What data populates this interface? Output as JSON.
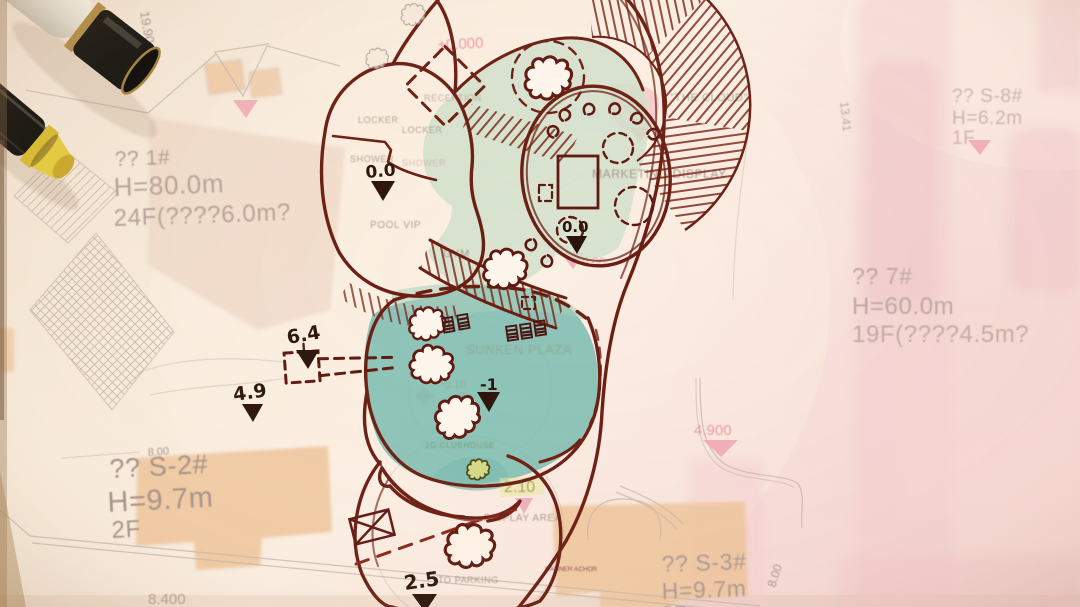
{
  "plan": {
    "b1": {
      "l1": "?? 1#",
      "l2": "H=80.0m",
      "l3": "24F(????6.0m?"
    },
    "s8": {
      "l1": "?? S-8#",
      "l2": "H=6.2m",
      "l3": "1F"
    },
    "b7": {
      "l1": "?? 7#",
      "l2": "H=60.0m",
      "l3": "19F(????4.5m?"
    },
    "s2": {
      "l1": "?? S-2#",
      "l2": "H=9.7m",
      "l3": "2F"
    },
    "s3": {
      "l1": "?? S-3#",
      "l2": "H=9.7m",
      "l3": "2F"
    },
    "levels": {
      "v1990": "19.90",
      "v1341": "13.41",
      "v800a": "8.00",
      "v800b": "8.00",
      "v8400": "8.400",
      "v4900": "4.900",
      "v210": "2.10"
    },
    "labels": {
      "display_area": "DISPLAY AREA",
      "to_parking": "TO PARKING",
      "anchor": "DANNER ACHOR"
    }
  },
  "sketch": {
    "printed": {
      "reception": "RECEPTION",
      "locker_a": "LOCKER",
      "locker_b": "LOCKER",
      "shower_a": "SHOWER",
      "shower_b": "SHOWER",
      "pool": "POOL VIP",
      "gym": "GYM",
      "cloud": "\"THE CLOUD\"",
      "marketing": "MARKETING DISPLAY",
      "marketing_level": "+0.00",
      "zero_level": "±0.000",
      "sunken": "SUNKEN PLAZA",
      "sunken_level": "-0.10",
      "clubhouse": "1G CLUBHOUSE"
    },
    "handwritten": {
      "shower": "0.0",
      "marketing": "0.0",
      "sunken": "-1",
      "bridge": "6.4",
      "west": "4.9",
      "parking": "2.5"
    }
  },
  "colors": {
    "paper": "#f9ecdc",
    "sketch_ink": "#6b1d12",
    "handwriting_ink": "#2b130b",
    "printed_text": "#a8968a",
    "pink_accent": "#ec9aa6",
    "pink_band": "#f2c6cb",
    "orange_footprint": "#eec49a",
    "teal_plaza": "#74b9ae",
    "light_green": "#cfe0ca",
    "yellow_highlight": "#e9e7a0",
    "pen_yellow": "#e3c93a"
  }
}
